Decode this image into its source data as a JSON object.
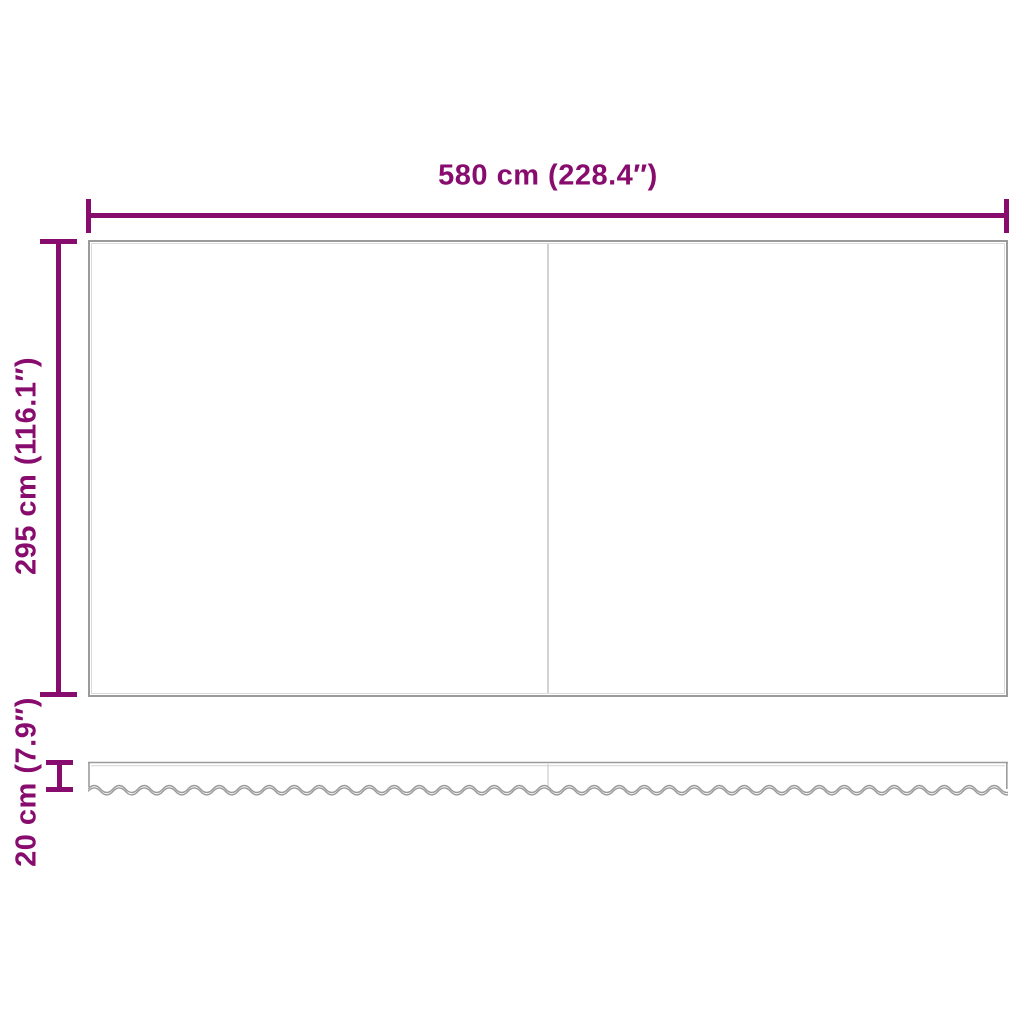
{
  "diagram": {
    "width_label": "580 cm (228.4″)",
    "height_label": "295 cm (116.1″)",
    "valance_height_label": "20 cm (7.9″)"
  },
  "colors": {
    "accent": "#880b6e",
    "outline": "#9b9b9b",
    "outline-light": "#dcdcdc",
    "seam": "#d2d2d2",
    "bg": "#ffffff"
  }
}
